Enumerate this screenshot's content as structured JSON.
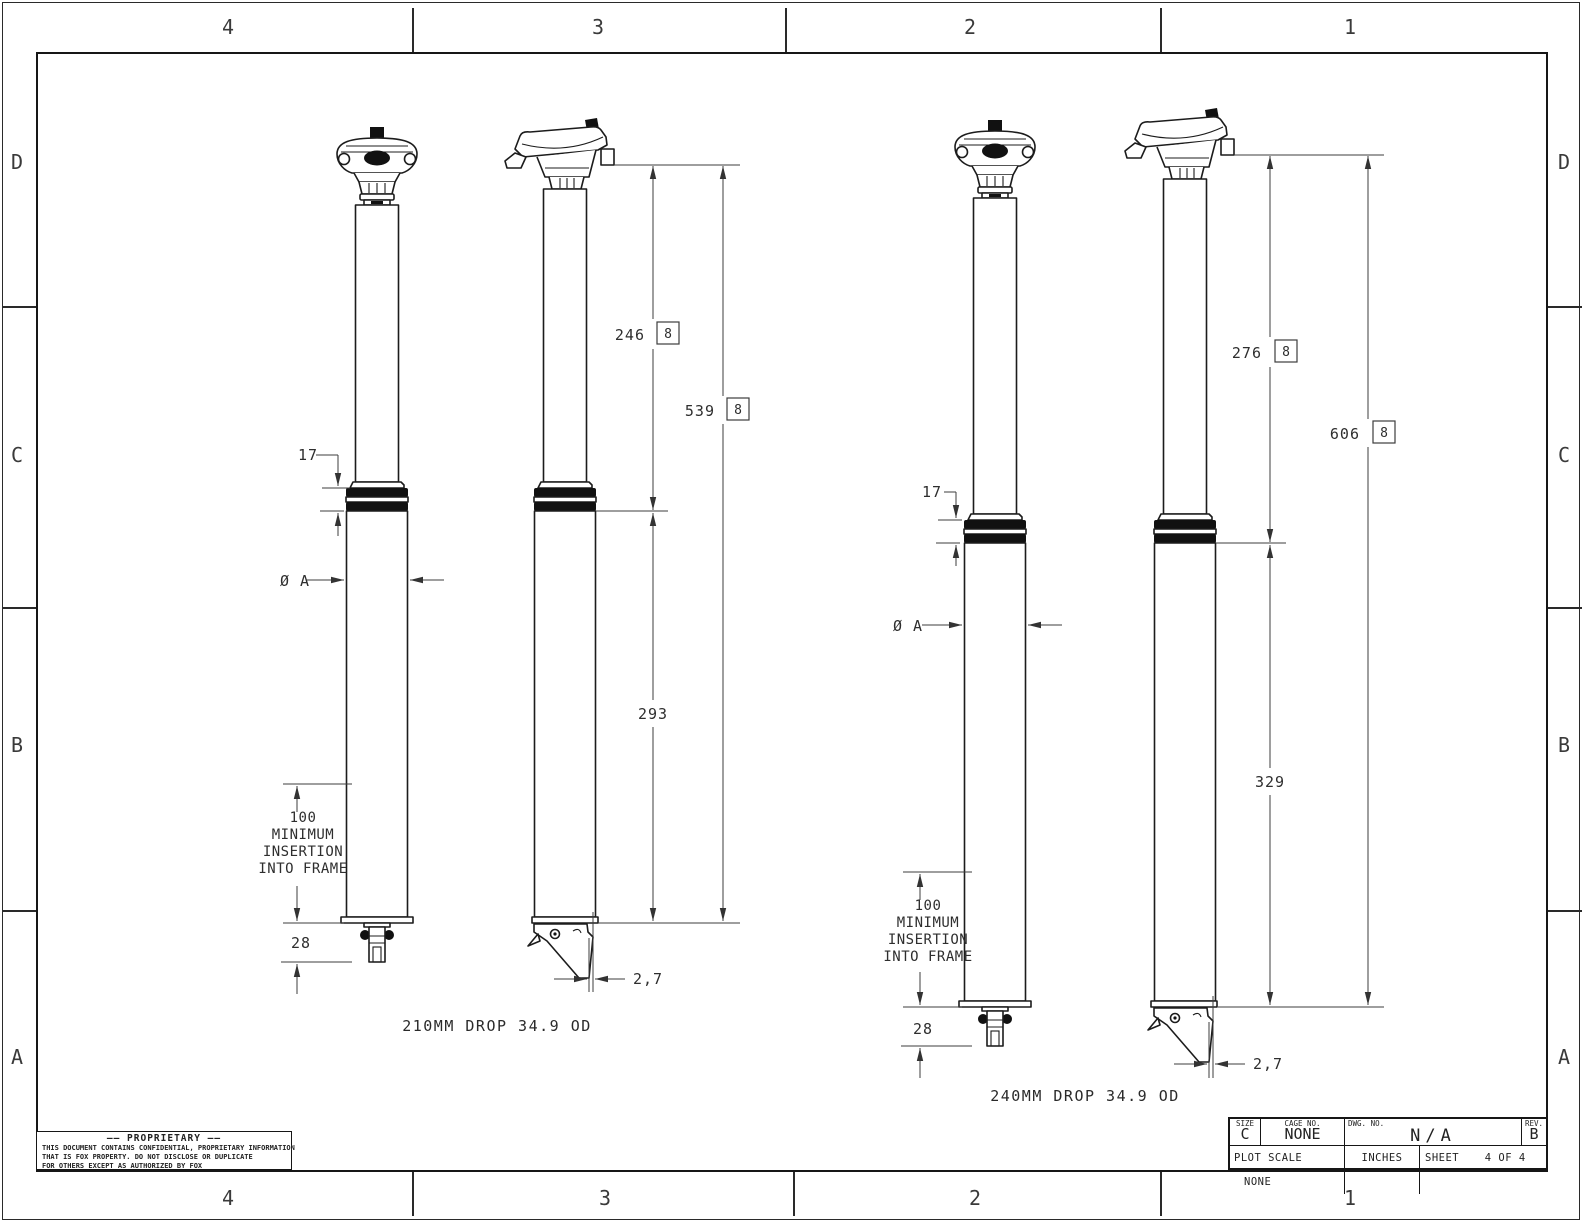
{
  "sheet": {
    "zone_columns": [
      "4",
      "3",
      "2",
      "1"
    ],
    "zone_rows": [
      "D",
      "C",
      "B",
      "A"
    ]
  },
  "views": {
    "left": {
      "caption": "210MM DROP  34.9 OD",
      "dim_upper": "246",
      "dim_upper_flag": "8",
      "dim_total": "539",
      "dim_total_flag": "8",
      "dim_lower": "293",
      "dim_collar_height": "17",
      "dim_diameter": "Ø A",
      "insertion_note": [
        "100",
        "MINIMUM",
        "INSERTION",
        "INTO FRAME"
      ],
      "dim_below_insertion": "28",
      "dim_lever_offset": "2,7"
    },
    "right": {
      "caption": "240MM DROP  34.9 OD",
      "dim_upper": "276",
      "dim_upper_flag": "8",
      "dim_total": "606",
      "dim_total_flag": "8",
      "dim_lower": "329",
      "dim_collar_height": "17",
      "dim_diameter": "Ø A",
      "insertion_note": [
        "100",
        "MINIMUM",
        "INSERTION",
        "INTO FRAME"
      ],
      "dim_below_insertion": "28",
      "dim_lever_offset": "2,7"
    }
  },
  "proprietary": {
    "title": "—— PROPRIETARY ——",
    "lines": [
      "THIS DOCUMENT CONTAINS CONFIDENTIAL, PROPRIETARY INFORMATION",
      "THAT IS FOX PROPERTY.  DO NOT DISCLOSE OR DUPLICATE",
      "FOR OTHERS EXCEPT AS AUTHORIZED BY FOX"
    ]
  },
  "title_block": {
    "size_label": "SIZE",
    "size_value": "C",
    "cage_label": "CAGE NO.",
    "cage_value": "NONE",
    "dwg_label": "DWG. NO.",
    "dwg_value": "N/A",
    "rev_label": "REV.",
    "rev_value": "B",
    "plot_scale_label": "PLOT SCALE",
    "plot_scale_value": "NONE",
    "units": "INCHES",
    "sheet_label": "SHEET",
    "sheet_value": "4 OF 4"
  }
}
